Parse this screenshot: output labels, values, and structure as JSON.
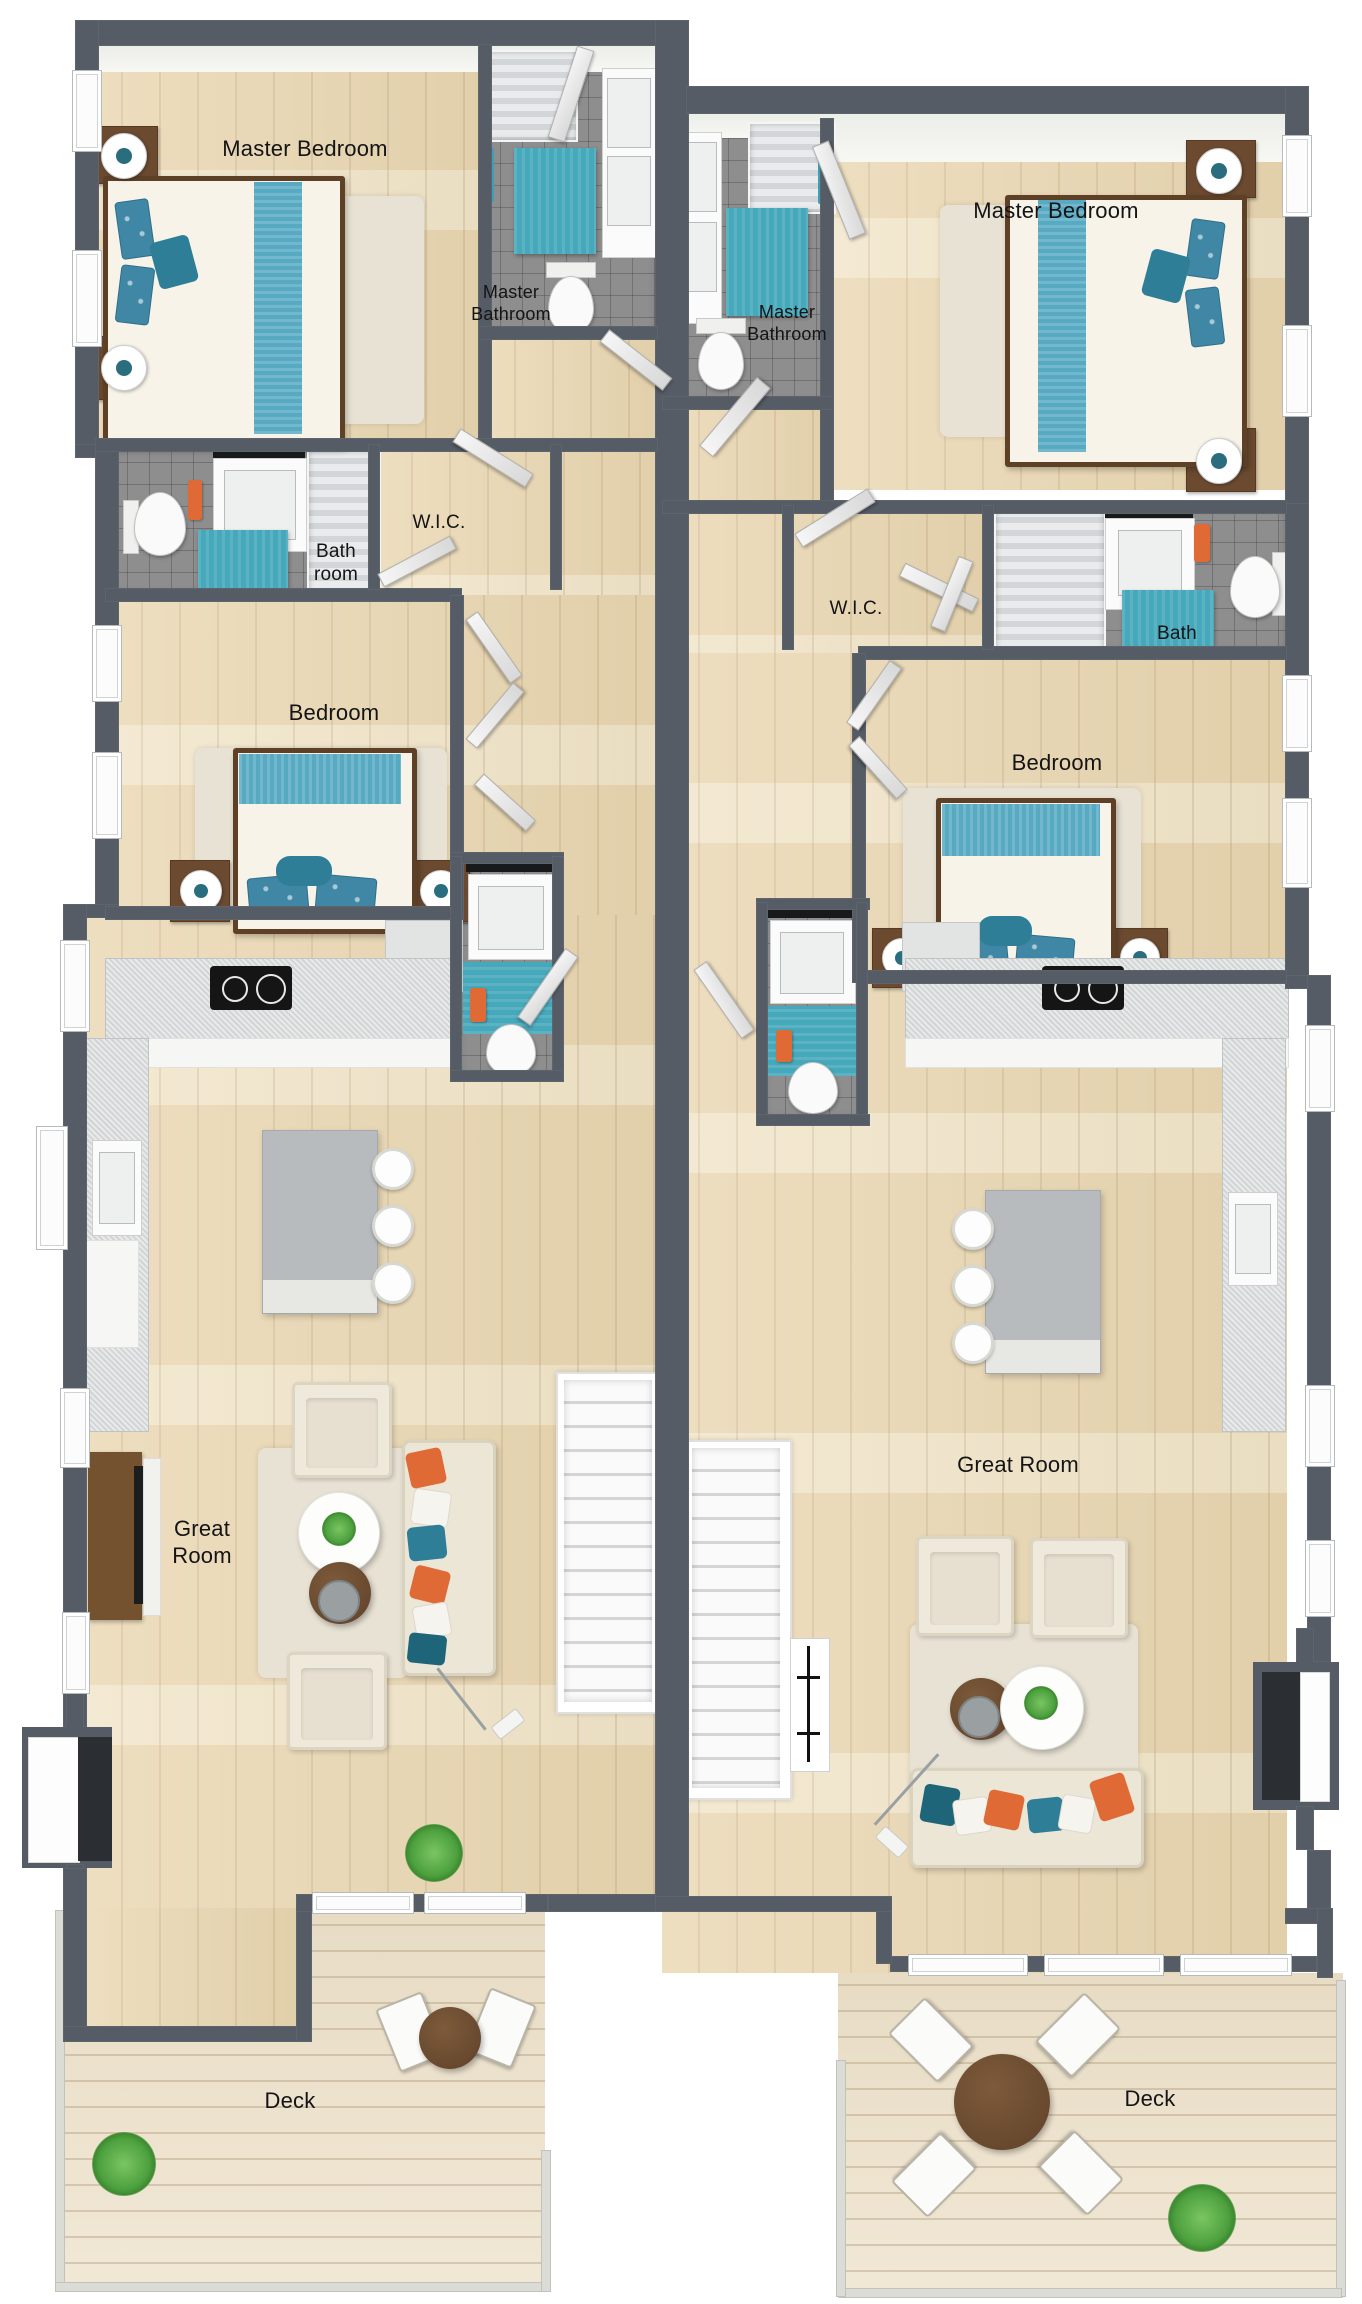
{
  "plan": {
    "background": "#ffffff",
    "wall_color": "#565c65",
    "wood_floor_color": "#e9d6b0",
    "deck_floor_color": "#ece0c8",
    "tile_color": "#8e8e8e",
    "accent_teal": "#45a8bb",
    "accent_teal_dark": "#2e7e97",
    "accent_orange": "#e06a35",
    "furniture_cream": "#ece6d6",
    "table_brown": "#6f4e31"
  },
  "labels": {
    "left_master_bedroom": "Master Bedroom",
    "left_master_bathroom": "Master Bathroom",
    "left_bath_room": "Bath room",
    "left_wic": "W.I.C.",
    "left_bedroom": "Bedroom",
    "left_great_room": "Great Room",
    "left_deck": "Deck",
    "right_master_bedroom": "Master Bedroom",
    "right_master_bathroom": "Master Bathroom",
    "right_wic": "W.I.C.",
    "right_bath": "Bath",
    "right_bedroom": "Bedroom",
    "right_great_room": "Great Room",
    "right_deck": "Deck"
  }
}
